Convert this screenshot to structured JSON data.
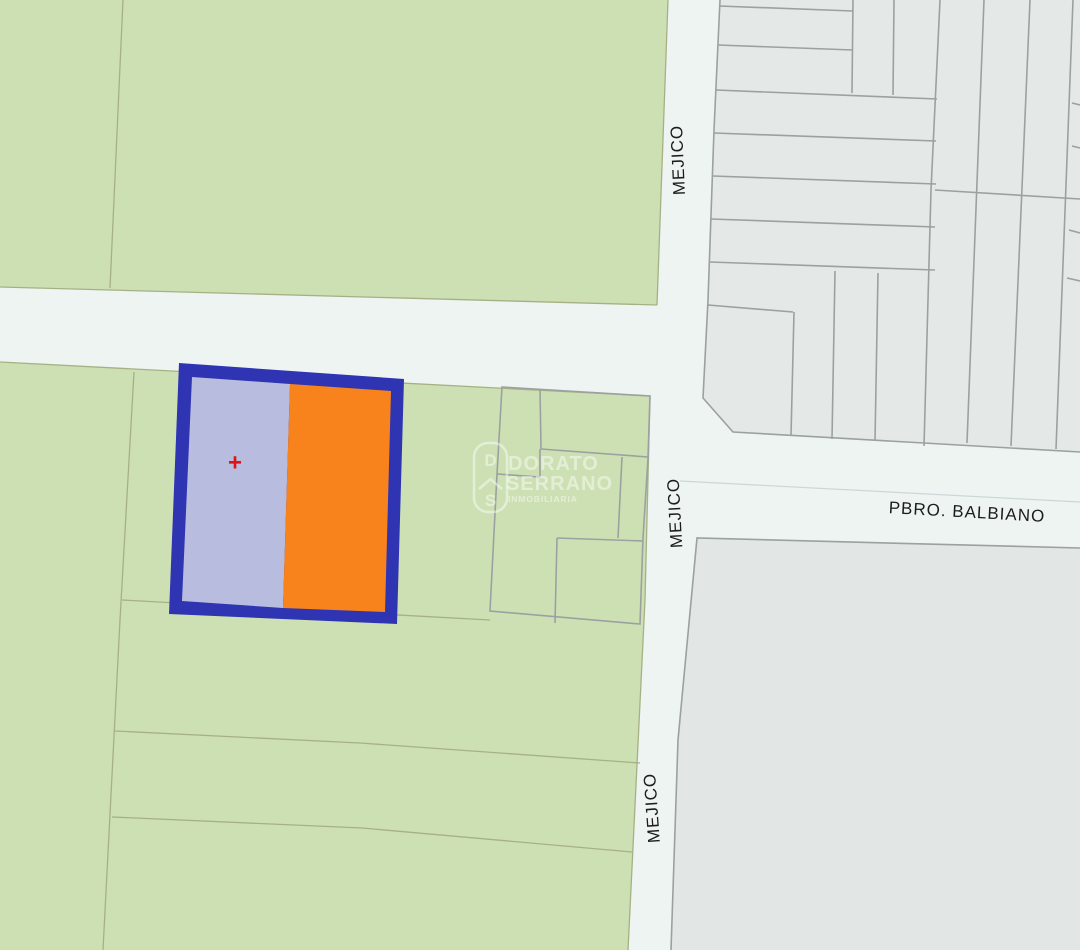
{
  "map": {
    "street_labels": {
      "mejico": "MEJICO",
      "balbiano": "PBRO. BALBIANO"
    },
    "highlight": {
      "marker": "+"
    },
    "colors": {
      "street": "#edf4f2",
      "parcel_green": "#cde0b4",
      "parcel_gray": "#e4e8e7",
      "parcel_gray_dark": "#e2e6e5",
      "green_line": "#a6b183",
      "gray_line": "#9ba1a1",
      "centerline": "#ccd6d7",
      "highlight_border": "#2e34b2",
      "highlight_left": "#b8bddf",
      "highlight_right": "#f8831c",
      "marker_red": "#dc1414",
      "label_color": "#1c1c1c"
    }
  },
  "watermark": {
    "logo_top": "D",
    "logo_bottom": "S",
    "line1": "DORATO",
    "line2": "SERRANO",
    "line3": "INMOBILIARIA"
  }
}
